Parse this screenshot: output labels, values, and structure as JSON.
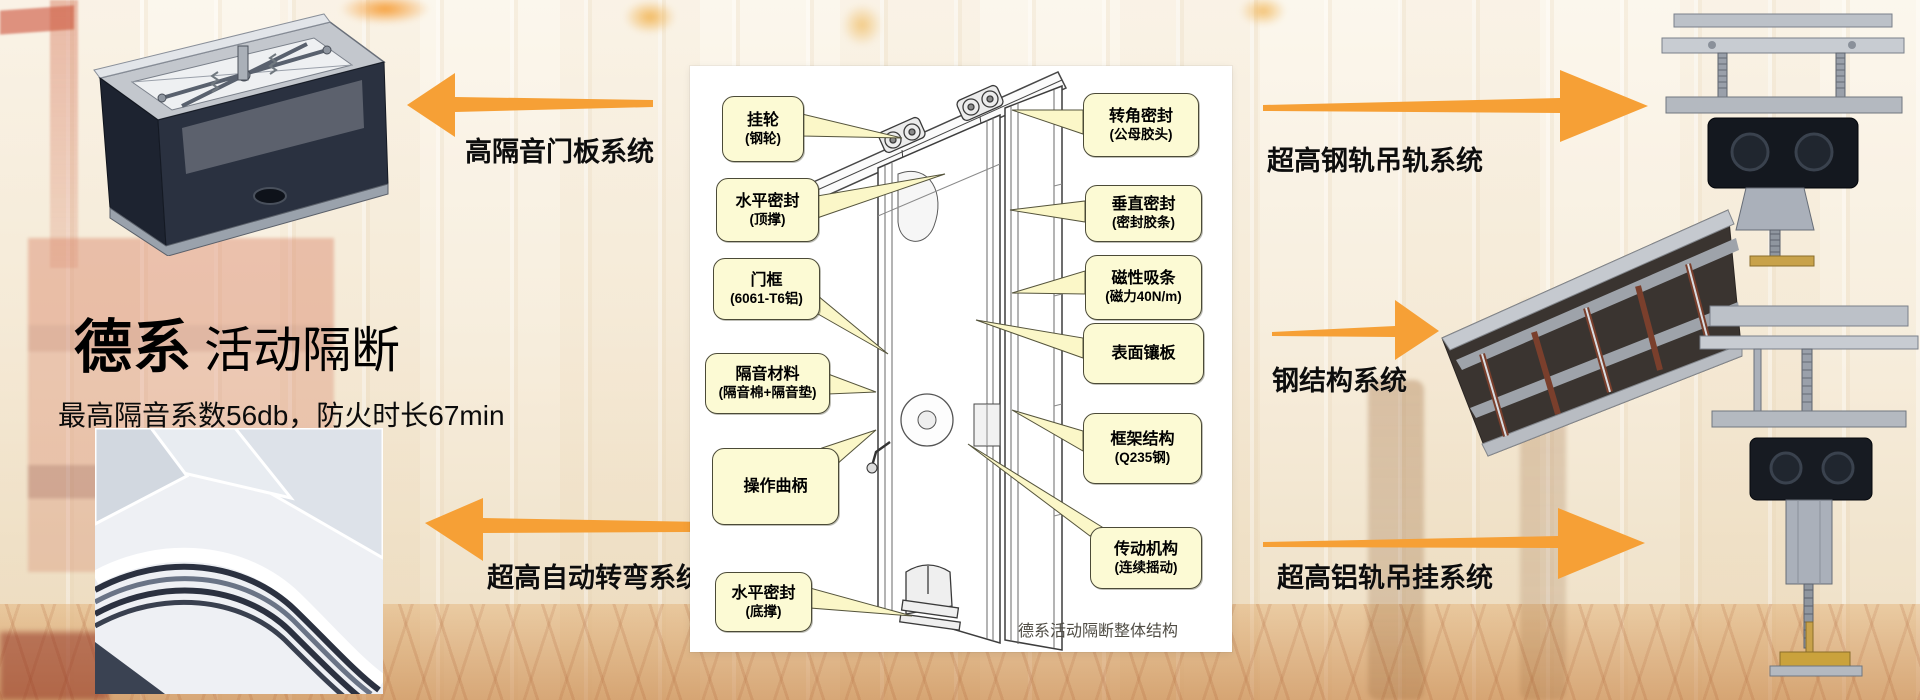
{
  "slide": {
    "title": {
      "emphasis": "德系",
      "rest": "活动隔断"
    },
    "subtitle": "最高隔音系数56db，防火时长67min"
  },
  "systems": {
    "door_panel": "高隔音门板系统",
    "auto_turn": "超高自动转弯系统",
    "steel_rail": "超高钢轨吊轨系统",
    "steel_structure": "钢结构系统",
    "aluminum_rail": "超高铝轨吊挂系统"
  },
  "diagram": {
    "caption": "德系活动隔断整体结构",
    "left_callouts": [
      {
        "line1": "挂轮",
        "line2": "(钢轮)"
      },
      {
        "line1": "水平密封",
        "line2": "(顶撑)"
      },
      {
        "line1": "门框",
        "line2": "(6061-T6铝)"
      },
      {
        "line1": "隔音材料",
        "line2": "(隔音棉+隔音垫)"
      },
      {
        "line1": "操作曲柄",
        "line2": ""
      },
      {
        "line1": "水平密封",
        "line2": "(底撑)"
      }
    ],
    "right_callouts": [
      {
        "line1": "转角密封",
        "line2": "(公母胶头)"
      },
      {
        "line1": "垂直密封",
        "line2": "(密封胶条)"
      },
      {
        "line1": "磁性吸条",
        "line2": "(磁力40N/m)"
      },
      {
        "line1": "表面镶板",
        "line2": ""
      },
      {
        "line1": "框架结构",
        "line2": "(Q235钢)"
      },
      {
        "line1": "传动机构",
        "line2": "(连续摇动)"
      }
    ]
  },
  "photos": {
    "top_left": "door-panel-mechanism",
    "bottom_left": "curved-track",
    "top_right": "steel-rail-hanger",
    "middle_right": "steel-structure-frame",
    "bottom_right": "aluminum-rail-hanger"
  },
  "colors": {
    "arrow_orange": "#F6A036",
    "callout_fill": "#FCFAD4",
    "callout_border": "#4B4A37",
    "panel_bg": "#FFFFFF"
  }
}
